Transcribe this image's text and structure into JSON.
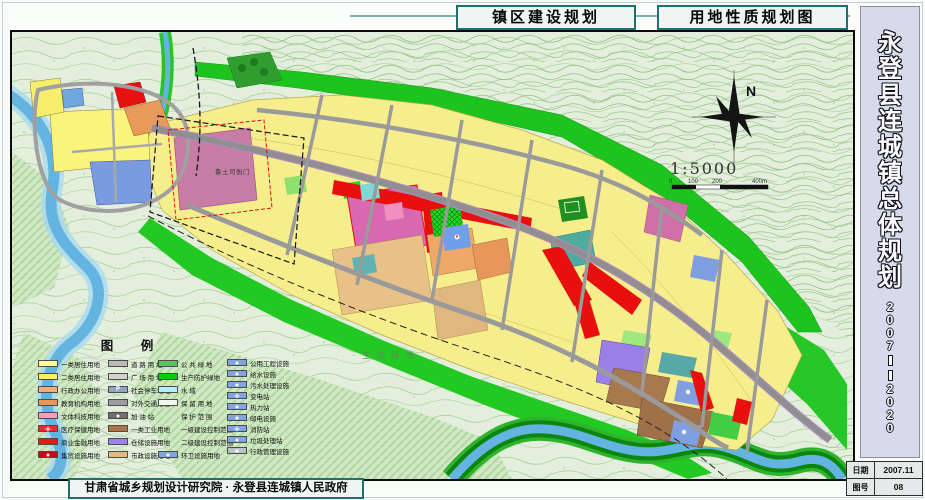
{
  "page_title": {
    "box1": "镇区建设规划",
    "box2": "用地性质规划图"
  },
  "sidebar": {
    "title": "永登县连城镇总体规划",
    "years": "2007——2020"
  },
  "footer": {
    "credit": "甘肃省城乡规划设计研究院 · 永登县连城镇人民政府"
  },
  "info_table": {
    "rows": [
      {
        "label": "日期",
        "value": "2007.11"
      },
      {
        "label": "图号",
        "value": "08"
      }
    ]
  },
  "map": {
    "labels": {
      "historic_site": "鲁土司衙门",
      "eco_green": "生态绿地"
    },
    "compass": {
      "north": "N"
    },
    "scale": {
      "ratio": "1:5000",
      "ticks": [
        "0",
        "100",
        "200",
        "400m"
      ]
    }
  },
  "legend": {
    "title": "图  例",
    "columns": [
      {
        "items": [
          {
            "label": "一类居住用地",
            "fill": "#fdf9a0"
          },
          {
            "label": "二类居住用地",
            "fill": "#fbf160"
          },
          {
            "label": "行政办公用地",
            "fill": "#f5ad7e"
          },
          {
            "label": "教育机构用地",
            "fill": "#eb9554"
          },
          {
            "label": "文体科技用地",
            "fill": "#f59ec4"
          },
          {
            "label": "医疗保健用地",
            "fill": "#e92a2a",
            "icon": "cross"
          },
          {
            "label": "商业金融用地",
            "fill": "#ee1515"
          },
          {
            "label": "集贸设施用地",
            "fill": "#c60d0d",
            "icon": "dot"
          }
        ]
      },
      {
        "items": [
          {
            "label": "道 路 用 地",
            "fill": "#bababa"
          },
          {
            "label": "广 场 用 地",
            "fill": "#d2d2cd"
          },
          {
            "label": "社会停车场地",
            "fill": "#8fa7c7",
            "icon": "P"
          },
          {
            "label": "对外交通用地",
            "fill": "#9e9e9e"
          },
          {
            "label": "加  油  站",
            "fill": "#707070",
            "icon": "dot"
          },
          {
            "label": "一类工业用地",
            "fill": "#ae7348"
          },
          {
            "label": "仓储设施用地",
            "fill": "#9d82e9"
          },
          {
            "label": "市政设施用地",
            "fill": "#e3ba80"
          }
        ]
      },
      {
        "items": [
          {
            "label": "公 共 绿 地",
            "fill": "#46d146"
          },
          {
            "label": "生产防护绿地",
            "fill": "#15c715"
          },
          {
            "label": "水      域",
            "fill": "#b5eafa"
          },
          {
            "label": "保 留 用 地",
            "fill": "#f0f7f0"
          },
          {
            "label": "保 护 范 围",
            "line": "red-dash"
          },
          {
            "label": "一级建设控制范围",
            "line": "black-dashdot"
          },
          {
            "label": "二级建设控制范围",
            "line": "blue-dash"
          },
          {
            "label": "环卫设施用地",
            "fill": "#82a5e2",
            "icon": "dot"
          }
        ]
      },
      {
        "items": [
          {
            "label": "公用工程设施",
            "fill": "#82a5e2",
            "icon": "dot"
          },
          {
            "label": "给水设施",
            "fill": "#82a5e2",
            "icon": "dot"
          },
          {
            "label": "污水处理设施",
            "fill": "#82a5e2",
            "icon": "dot"
          },
          {
            "label": "变电站",
            "fill": "#82a5e2",
            "icon": "cross"
          },
          {
            "label": "热力站",
            "fill": "#82a5e2",
            "icon": "dot"
          },
          {
            "label": "邮电设施",
            "fill": "#82a5e2",
            "icon": "dot"
          },
          {
            "label": "消防站",
            "fill": "#82a5e2",
            "icon": "cross"
          },
          {
            "label": "垃圾处理站",
            "fill": "#82a5e2",
            "icon": "dot"
          },
          {
            "label": "行政管理设施",
            "fill": "#b9c3c9",
            "icon": "dot"
          }
        ]
      }
    ]
  },
  "colors": {
    "residential_yellow": "#f6ee8c",
    "commercial_red": "#e80f0f",
    "culture_pink": "#d868b0",
    "industry_brown": "#a8784f",
    "warehouse_purple": "#9b7fe8",
    "green_protect": "#1ec41e",
    "water_blue": "#64b4e2",
    "road_gray": "#9a9a9a",
    "frame_teal": "#20706e",
    "sidebar_bg": "#d6daea"
  }
}
